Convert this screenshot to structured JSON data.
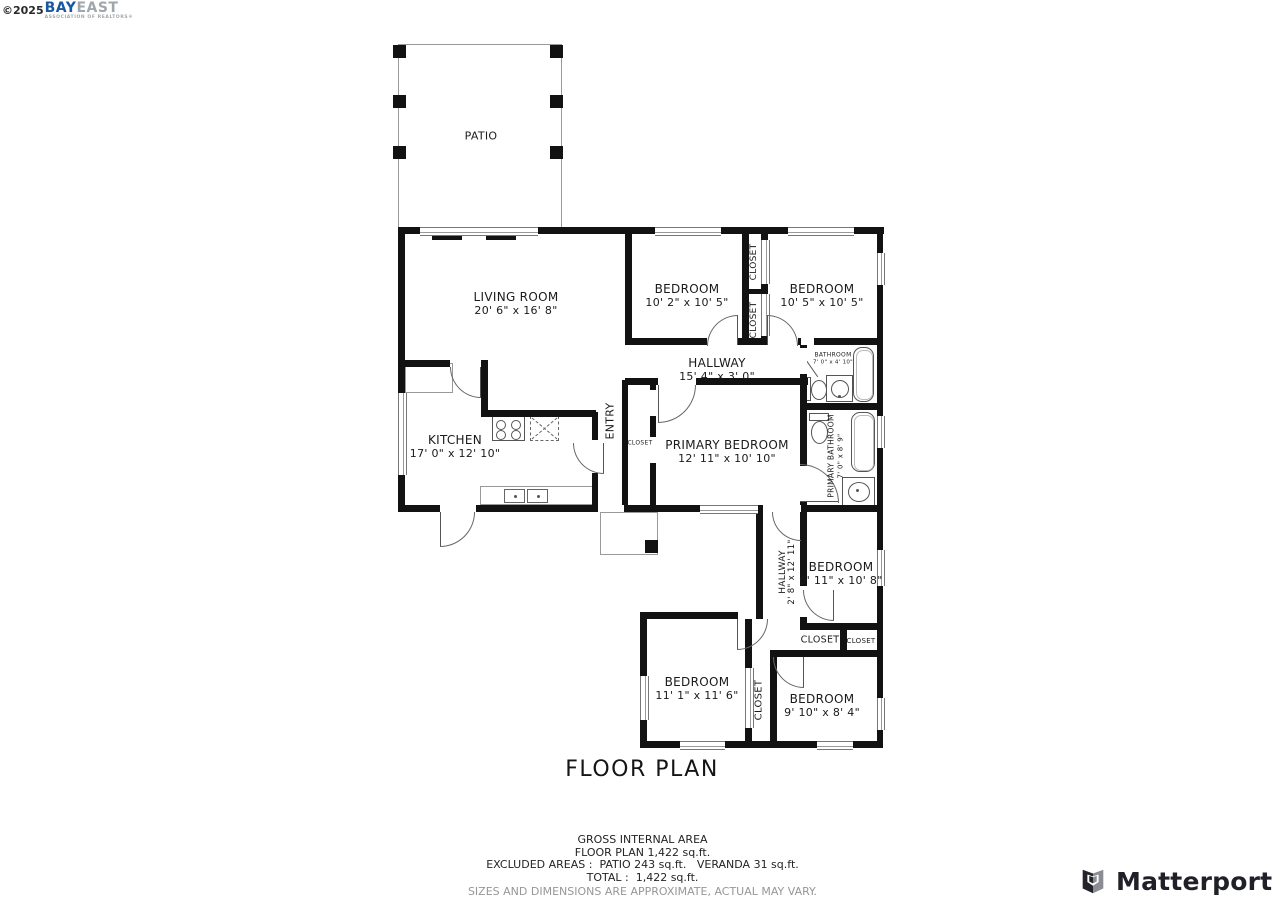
{
  "branding": {
    "copyright": "©2025",
    "logo_primary": "BAY",
    "logo_secondary": "EAST",
    "logo_caption": "ASSOCIATION OF REALTORS®",
    "matterport": "Matterport"
  },
  "title": "FLOOR PLAN",
  "rooms": {
    "patio": {
      "name": "PATIO"
    },
    "living_room": {
      "name": "LIVING ROOM",
      "dims": "20' 6\" x 16' 8\""
    },
    "bedroom_top_middle": {
      "name": "BEDROOM",
      "dims": "10' 2\" x 10' 5\""
    },
    "bedroom_top_right": {
      "name": "BEDROOM",
      "dims": "10' 5\" x 10' 5\""
    },
    "closet_top_upper": {
      "name": "CLOSET"
    },
    "closet_top_lower": {
      "name": "CLOSET"
    },
    "hallway_top": {
      "name": "HALLWAY",
      "dims": "15' 4\" x 3' 0\""
    },
    "bathroom": {
      "name": "BATHROOM",
      "dims": "7' 0\" x 4' 10\""
    },
    "kitchen": {
      "name": "KITCHEN",
      "dims": "17' 0\" x 12' 10\""
    },
    "entry": {
      "name": "ENTRY"
    },
    "closet_entry": {
      "name": "CLOSET"
    },
    "primary_bedroom": {
      "name": "PRIMARY BEDROOM",
      "dims": "12' 11\" x 10' 10\""
    },
    "primary_bathroom": {
      "name": "PRIMARY BATHROOM",
      "dims": "7' 0\" x 8' 9\""
    },
    "hallway_middle": {
      "name": "HALLWAY",
      "dims": "2' 8\" x 12' 11\""
    },
    "bedroom_right": {
      "name": "BEDROOM",
      "dims": "6' 11\" x 10' 8\""
    },
    "closet_row_left": {
      "name": "CLOSET"
    },
    "closet_row_right": {
      "name": "CLOSET"
    },
    "bedroom_bottom_left": {
      "name": "BEDROOM",
      "dims": "11' 1\" x 11' 6\""
    },
    "closet_bottom": {
      "name": "CLOSET"
    },
    "bedroom_bottom_right": {
      "name": "BEDROOM",
      "dims": "9' 10\" x 8' 4\""
    }
  },
  "summary": {
    "line1": "GROSS INTERNAL AREA",
    "line2": "FLOOR PLAN 1,422 sq.ft.",
    "line3": "EXCLUDED AREAS :  PATIO 243 sq.ft.   VERANDA 31 sq.ft.",
    "line4": "TOTAL :  1,422 sq.ft.",
    "disclaimer": "SIZES AND DIMENSIONS ARE APPROXIMATE, ACTUAL MAY VARY."
  },
  "colors": {
    "wall": "#121212",
    "logo_blue": "#1a57a0",
    "logo_gray": "#a0a6ac",
    "matterport_dark": "#202128"
  }
}
